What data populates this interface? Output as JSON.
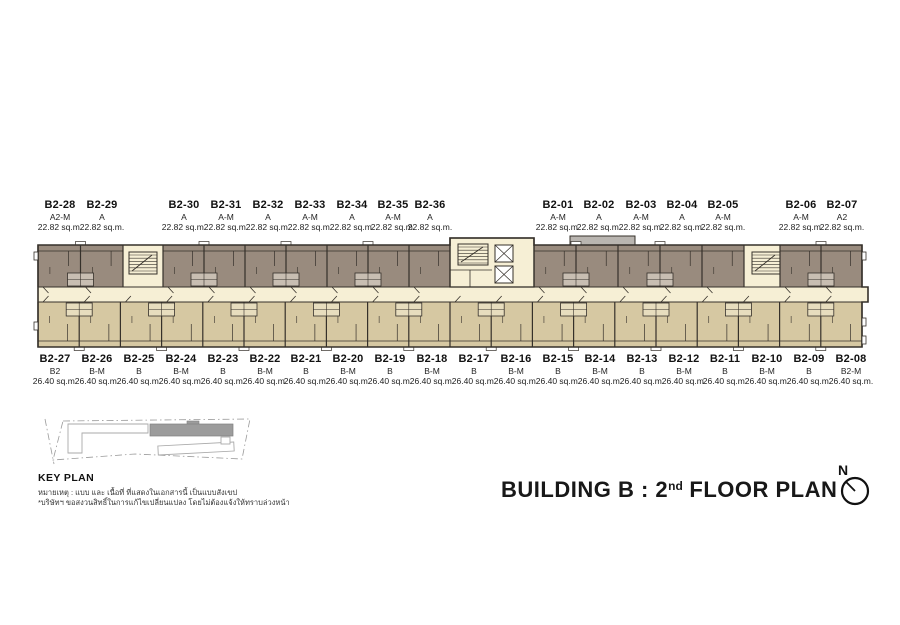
{
  "title": {
    "prefix": "BUILDING B : 2",
    "superscript": "nd",
    "suffix": " FLOOR PLAN"
  },
  "key_plan": {
    "label": "KEY PLAN",
    "note1": "หมายเหตุ : แบบ และ เนื้อที่ ที่แสดงในเอกสารนี้ เป็นแบบสังเขป",
    "note2": "*บริษัทฯ ขอสงวนสิทธิ์ในการแก้ไขเปลี่ยนแปลง โดยไม่ต้องแจ้งให้ทราบล่วงหน้า"
  },
  "compass": {
    "label": "N"
  },
  "units_top": [
    {
      "id": "B2-28",
      "type": "A2-M",
      "area": "22.82 sq.m.",
      "x": 60
    },
    {
      "id": "B2-29",
      "type": "A",
      "area": "22.82 sq.m.",
      "x": 102
    },
    {
      "id": "B2-30",
      "type": "A",
      "area": "22.82 sq.m.",
      "x": 184
    },
    {
      "id": "B2-31",
      "type": "A-M",
      "area": "22.82 sq.m.",
      "x": 226
    },
    {
      "id": "B2-32",
      "type": "A",
      "area": "22.82 sq.m.",
      "x": 268
    },
    {
      "id": "B2-33",
      "type": "A-M",
      "area": "22.82 sq.m.",
      "x": 310
    },
    {
      "id": "B2-34",
      "type": "A",
      "area": "22.82 sq.m.",
      "x": 352
    },
    {
      "id": "B2-35",
      "type": "A-M",
      "area": "22.82 sq.m.",
      "x": 393
    },
    {
      "id": "B2-36",
      "type": "A",
      "area": "22.82 sq.m.",
      "x": 430
    },
    {
      "id": "B2-01",
      "type": "A-M",
      "area": "22.82 sq.m.",
      "x": 558
    },
    {
      "id": "B2-02",
      "type": "A",
      "area": "22.82 sq.m.",
      "x": 599
    },
    {
      "id": "B2-03",
      "type": "A-M",
      "area": "22.82 sq.m.",
      "x": 641
    },
    {
      "id": "B2-04",
      "type": "A",
      "area": "22.82 sq.m.",
      "x": 682
    },
    {
      "id": "B2-05",
      "type": "A-M",
      "area": "22.82 sq.m.",
      "x": 723
    },
    {
      "id": "B2-06",
      "type": "A-M",
      "area": "22.82 sq.m.",
      "x": 801
    },
    {
      "id": "B2-07",
      "type": "A2",
      "area": "22.82 sq.m.",
      "x": 842
    }
  ],
  "units_bottom": [
    {
      "id": "B2-27",
      "type": "B2",
      "area": "26.40 sq.m.",
      "x": 55
    },
    {
      "id": "B2-26",
      "type": "B-M",
      "area": "26.40 sq.m.",
      "x": 97
    },
    {
      "id": "B2-25",
      "type": "B",
      "area": "26.40 sq.m.",
      "x": 139
    },
    {
      "id": "B2-24",
      "type": "B-M",
      "area": "26.40 sq.m.",
      "x": 181
    },
    {
      "id": "B2-23",
      "type": "B",
      "area": "26.40 sq.m.",
      "x": 223
    },
    {
      "id": "B2-22",
      "type": "B-M",
      "area": "26.40 sq.m.",
      "x": 265
    },
    {
      "id": "B2-21",
      "type": "B",
      "area": "26.40 sq.m.",
      "x": 306
    },
    {
      "id": "B2-20",
      "type": "B-M",
      "area": "26.40 sq.m.",
      "x": 348
    },
    {
      "id": "B2-19",
      "type": "B",
      "area": "26.40 sq.m.",
      "x": 390
    },
    {
      "id": "B2-18",
      "type": "B-M",
      "area": "26.40 sq.m.",
      "x": 432
    },
    {
      "id": "B2-17",
      "type": "B",
      "area": "26.40 sq.m.",
      "x": 474
    },
    {
      "id": "B2-16",
      "type": "B-M",
      "area": "26.40 sq.m.",
      "x": 516
    },
    {
      "id": "B2-15",
      "type": "B",
      "area": "26.40 sq.m.",
      "x": 558
    },
    {
      "id": "B2-14",
      "type": "B-M",
      "area": "26.40 sq.m.",
      "x": 600
    },
    {
      "id": "B2-13",
      "type": "B",
      "area": "26.40 sq.m.",
      "x": 642
    },
    {
      "id": "B2-12",
      "type": "B-M",
      "area": "26.40 sq.m.",
      "x": 684
    },
    {
      "id": "B2-11",
      "type": "B",
      "area": "26.40 sq.m.",
      "x": 725
    },
    {
      "id": "B2-10",
      "type": "B-M",
      "area": "26.40 sq.m.",
      "x": 767
    },
    {
      "id": "B2-09",
      "type": "B",
      "area": "26.40 sq.m.",
      "x": 809
    },
    {
      "id": "B2-08",
      "type": "B2-M",
      "area": "26.40 sq.m.",
      "x": 851
    }
  ],
  "colors": {
    "unit_top": "#998b7e",
    "unit_bottom": "#d6c8a2",
    "corridor": "#f6efd5",
    "bath_top": "#c8beb2",
    "bath_bottom": "#e7ddbe",
    "wall": "#35302a",
    "canopy": "#b9b5b0",
    "keyplan_building": "#9c9c9c",
    "keyplan_outline": "#aaaaaa"
  }
}
